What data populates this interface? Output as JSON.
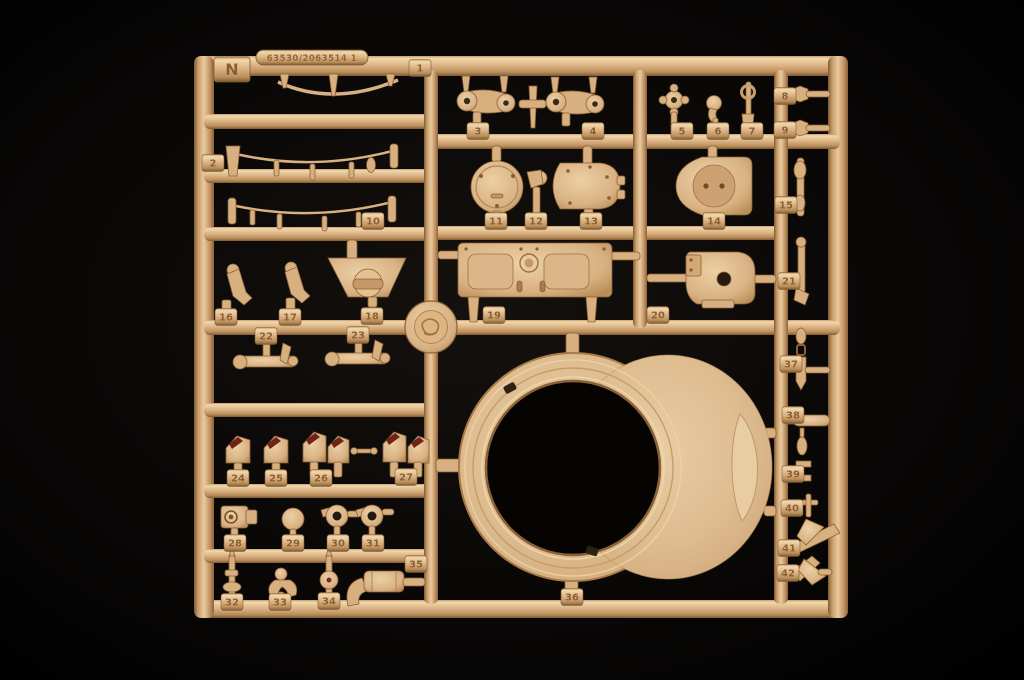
{
  "photo": {
    "subject": "model-kit-sprue",
    "background_color": "#060504"
  },
  "sprue": {
    "letter": "N",
    "mold_text": "63530/2063514 1",
    "part_tab_labels": "1-42"
  },
  "colors": {
    "plastic_base": "#d7ac77",
    "plastic_light": "#efd5aa",
    "plastic_shadow": "#8a6238",
    "recess_red": "#6e2418",
    "background": "#060504"
  },
  "parts": [
    {
      "label": "1"
    },
    {
      "label": "2"
    },
    {
      "label": "3"
    },
    {
      "label": "4"
    },
    {
      "label": "5"
    },
    {
      "label": "6"
    },
    {
      "label": "7"
    },
    {
      "label": "8"
    },
    {
      "label": "9"
    },
    {
      "label": "10"
    },
    {
      "label": "11"
    },
    {
      "label": "12"
    },
    {
      "label": "13"
    },
    {
      "label": "14"
    },
    {
      "label": "15"
    },
    {
      "label": "16"
    },
    {
      "label": "17"
    },
    {
      "label": "18"
    },
    {
      "label": "19"
    },
    {
      "label": "20"
    },
    {
      "label": "21"
    },
    {
      "label": "22"
    },
    {
      "label": "23"
    },
    {
      "label": "24"
    },
    {
      "label": "25"
    },
    {
      "label": "26"
    },
    {
      "label": "27"
    },
    {
      "label": "28"
    },
    {
      "label": "29"
    },
    {
      "label": "30"
    },
    {
      "label": "31"
    },
    {
      "label": "32"
    },
    {
      "label": "33"
    },
    {
      "label": "34"
    },
    {
      "label": "35"
    },
    {
      "label": "36"
    },
    {
      "label": "37"
    },
    {
      "label": "38"
    },
    {
      "label": "39"
    },
    {
      "label": "40"
    },
    {
      "label": "41"
    },
    {
      "label": "42"
    }
  ]
}
